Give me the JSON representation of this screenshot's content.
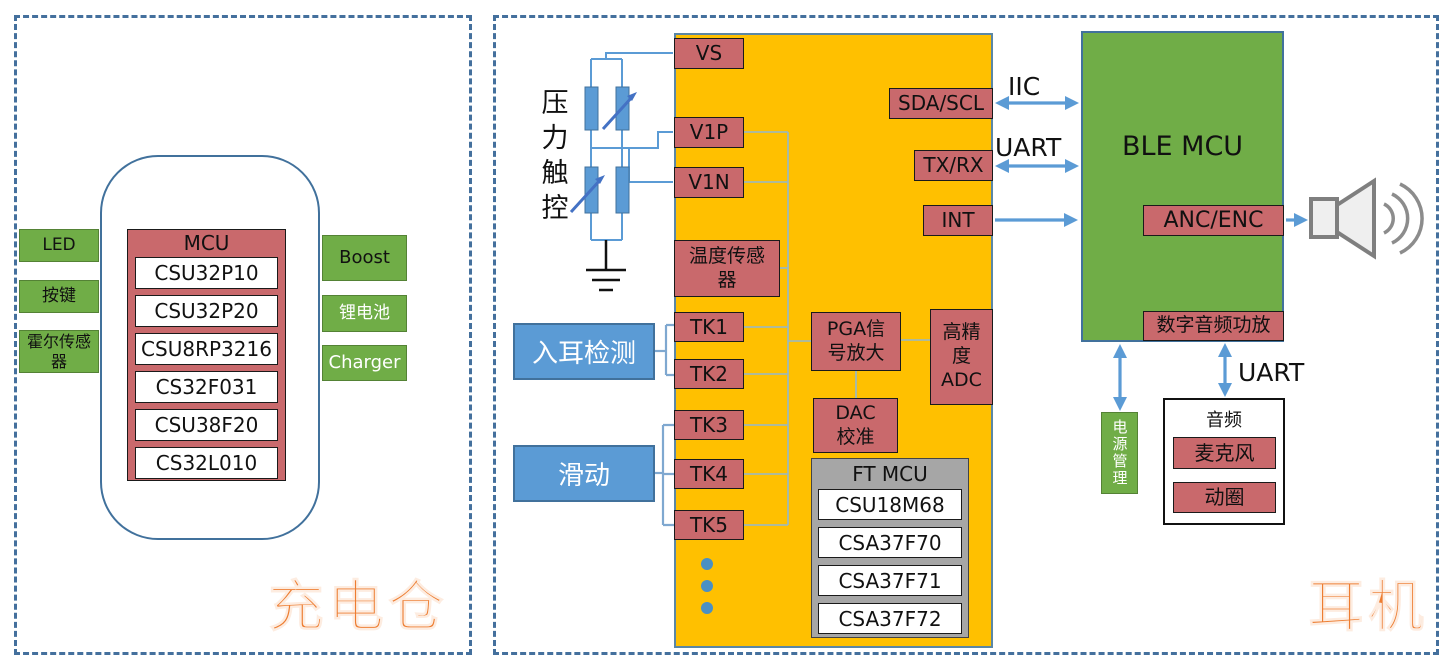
{
  "panels": {
    "left_caption": "充电仓",
    "right_caption": "耳机"
  },
  "charging_case": {
    "modules_left": [
      "LED",
      "按键",
      "霍尔传感器"
    ],
    "modules_right": [
      "Boost",
      "锂电池",
      "Charger"
    ],
    "mcu": {
      "title": "MCU",
      "chips": [
        "CSU32P10",
        "CSU32P20",
        "CSU8RP3216",
        "CS32F031",
        "CSU38F20",
        "CS32L010"
      ]
    }
  },
  "earbud": {
    "pressure_label": "压力触控",
    "in_ear_detect": "入耳检测",
    "slide": "滑动",
    "touch_chip": {
      "pin_vs": "VS",
      "pin_v1p": "V1P",
      "pin_v1n": "V1N",
      "temp_sensor": "温度传感器",
      "tk_pins": [
        "TK1",
        "TK2",
        "TK3",
        "TK4",
        "TK5"
      ],
      "pga": "PGA信号放大",
      "adc": "高精度ADC",
      "dac": "DAC校准",
      "pin_sda": "SDA/SCL",
      "pin_txrx": "TX/RX",
      "pin_int": "INT",
      "ft_mcu": {
        "title": "FT MCU",
        "chips": [
          "CSU18M68",
          "CSA37F70",
          "CSA37F71",
          "CSA37F72"
        ]
      }
    },
    "buses": {
      "iic": "IIC",
      "uart_top": "UART",
      "uart_bottom": "UART"
    },
    "ble_mcu": {
      "title": "BLE MCU",
      "anc": "ANC/ENC",
      "amp": "数字音频功放"
    },
    "power_mgmt": "电源管理",
    "audio": {
      "title": "音频",
      "mic": "麦克风",
      "coil": "动圈"
    }
  },
  "colors": {
    "rose": "#C9696C",
    "yellow": "#FFC000",
    "green": "#70AD47",
    "blue": "#5B9BD5",
    "steel_dash": "#44709D",
    "gray": "#A6A6A6",
    "caption_orange": "#ED7D31"
  }
}
